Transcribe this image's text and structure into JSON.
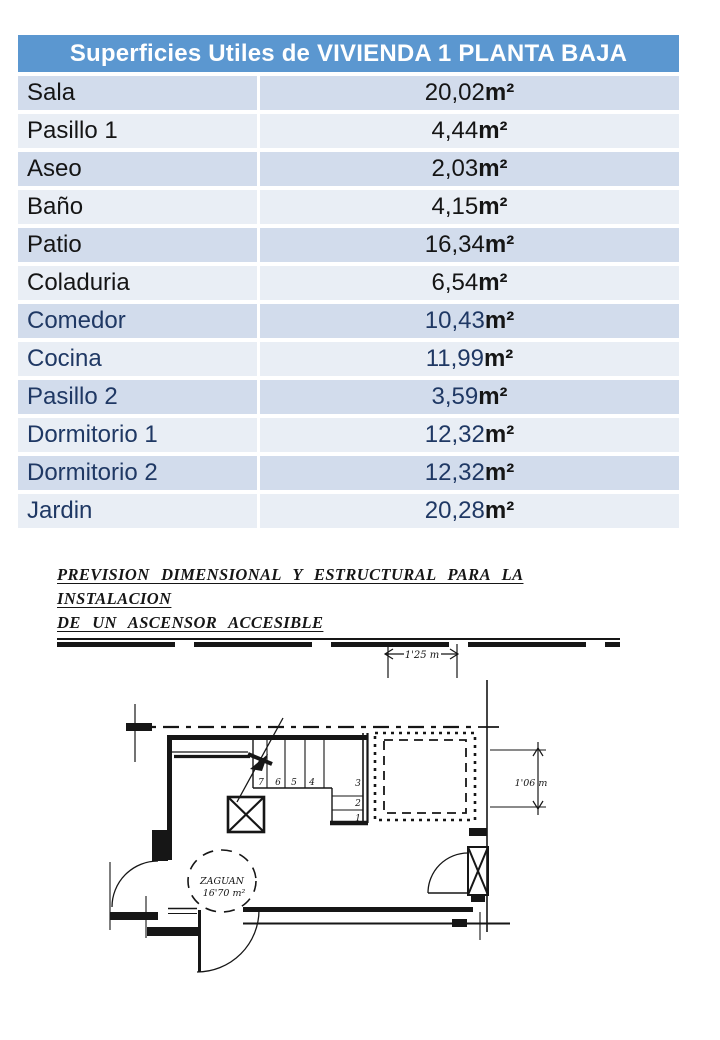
{
  "table": {
    "title": "Superficies Utiles de VIVIENDA 1 PLANTA BAJA",
    "rows": [
      {
        "label": "Sala",
        "value": "20,02 ",
        "unit": "m²",
        "ink": "black"
      },
      {
        "label": "Pasillo 1",
        "value": "4,44 ",
        "unit": "m²",
        "ink": "black"
      },
      {
        "label": "Aseo",
        "value": "2,03 ",
        "unit": "m²",
        "ink": "black"
      },
      {
        "label": "Baño",
        "value": "4,15",
        "unit": "m²",
        "ink": "black"
      },
      {
        "label": "Patio",
        "value": "16,34 ",
        "unit": "m²",
        "ink": "black"
      },
      {
        "label": "Coladuria",
        "value": "6,54 ",
        "unit": "m²",
        "ink": "black"
      },
      {
        "label": "Comedor",
        "value": "10,43 ",
        "unit": "m²",
        "ink": "navy"
      },
      {
        "label": "Cocina",
        "value": "11,99 ",
        "unit": "m²",
        "ink": "navy"
      },
      {
        "label": "Pasillo 2",
        "value": "3,59 ",
        "unit": "m²",
        "ink": "navy"
      },
      {
        "label": "Dormitorio 1",
        "value": "12,32 ",
        "unit": "m²",
        "ink": "navy"
      },
      {
        "label": "Dormitorio 2",
        "value": "12,32 ",
        "unit": "m²",
        "ink": "navy"
      },
      {
        "label": "Jardin",
        "value": "20,28 ",
        "unit": "m²",
        "ink": "navy"
      }
    ],
    "colors": {
      "header_bg": "#5B97D0",
      "header_text": "#FFFFFF",
      "row_dark": "#D2DCEC",
      "row_light": "#E9EEF5",
      "ink_black": "#151515",
      "ink_navy": "#1F3864"
    }
  },
  "drawing": {
    "title_line1": "PREVISION DIMENSIONAL Y ESTRUCTURAL PARA LA INSTALACION",
    "title_line2": "DE UN ASCENSOR ACCESIBLE",
    "dimensions": {
      "top": "1'25 m",
      "right": "1'06 m"
    },
    "room": {
      "name": "ZAGUAN",
      "area": "16'70 m²"
    },
    "stairs": {
      "steps": [
        "7",
        "6",
        "5",
        "4",
        "3",
        "2",
        "1"
      ]
    }
  }
}
